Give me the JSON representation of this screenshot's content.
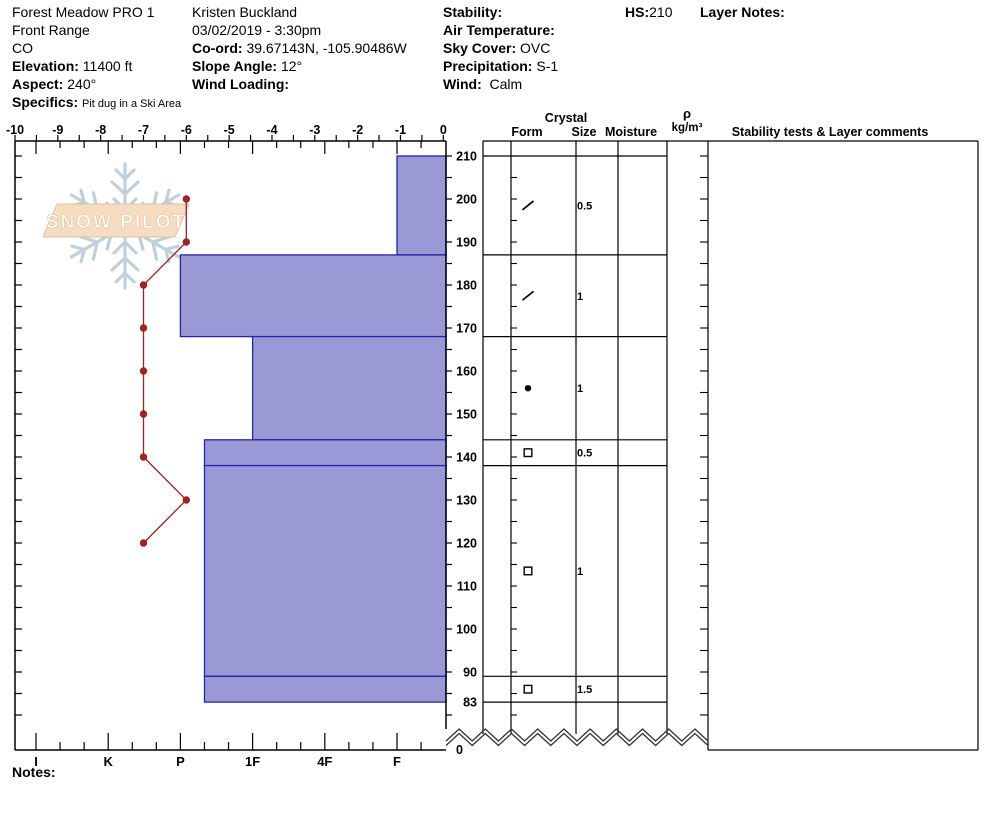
{
  "header": {
    "pit_name": "Forest Meadow PRO 1",
    "range": "Front Range",
    "state": "CO",
    "elevation_label": "Elevation:",
    "elevation_value": "11400 ft",
    "aspect_label": "Aspect:",
    "aspect_value": "240°",
    "specifics_label": "Specifics:",
    "specifics_value": "Pit dug in a Ski Area",
    "observer": "Kristen Buckland",
    "datetime": "03/02/2019 - 3:30pm",
    "coord_label": "Co-ord:",
    "coord_value": "39.67143N, -105.90486W",
    "slope_angle_label": "Slope Angle:",
    "slope_angle_value": "12°",
    "wind_loading_label": "Wind Loading:",
    "wind_loading_value": "",
    "stability_label": "Stability:",
    "stability_value": "",
    "air_temp_label": "Air Temperature:",
    "air_temp_value": "",
    "sky_cover_label": "Sky Cover:",
    "sky_cover_value": "OVC",
    "precipitation_label": "Precipitation:",
    "precipitation_value": "S-1",
    "wind_label": "Wind:",
    "wind_value": "Calm",
    "hs_label": "HS:",
    "hs_value": "210",
    "layer_notes_label": "Layer Notes:"
  },
  "watermark": {
    "text": "SNOW PILOT"
  },
  "table_headers": {
    "crystal": "Crystal",
    "form": "Form",
    "size": "Size",
    "moisture": "Moisture",
    "rho": "ρ",
    "rho_units": "kg/m³",
    "comments": "Stability tests & Layer comments"
  },
  "notes_label": "Notes:",
  "chart_data": {
    "type": "snow-profile",
    "title": "Snow pit profile: hardness layers vs depth with temperature trace",
    "depth_axis": {
      "unit": "cm",
      "surface": 210,
      "pit_bottom": 83,
      "tick_labels": [
        210,
        200,
        190,
        180,
        170,
        160,
        150,
        140,
        130,
        120,
        110,
        100,
        90,
        83
      ],
      "ground_label": "0",
      "minor_tick_step_cm": 5
    },
    "temp_axis": {
      "unit": "°C",
      "tick_labels": [
        -10,
        -9,
        -8,
        -7,
        -6,
        -5,
        -4,
        -3,
        -2,
        -1,
        0
      ],
      "minor_step": 0.5,
      "range": [
        -10,
        0
      ]
    },
    "hardness_axis": {
      "categories": [
        "I",
        "K",
        "P",
        "1F",
        "4F",
        "F"
      ]
    },
    "layers": [
      {
        "top": 210,
        "bottom": 187,
        "hardness": "F",
        "form": "decomposing",
        "size": "0.5",
        "moisture": "",
        "comments": ""
      },
      {
        "top": 187,
        "bottom": 168,
        "hardness": "P",
        "form": "decomposing",
        "size": "1",
        "moisture": "",
        "comments": ""
      },
      {
        "top": 168,
        "bottom": 144,
        "hardness": "1F",
        "form": "rounds",
        "size": "1",
        "moisture": "",
        "comments": ""
      },
      {
        "top": 144,
        "bottom": 138,
        "hardness": "P+",
        "form": "facets",
        "size": "0.5",
        "moisture": "",
        "comments": ""
      },
      {
        "top": 138,
        "bottom": 89,
        "hardness": "P+",
        "form": "facets",
        "size": "1",
        "moisture": "",
        "comments": ""
      },
      {
        "top": 89,
        "bottom": 83,
        "hardness": "P+",
        "form": "facets",
        "size": "1.5",
        "moisture": "",
        "comments": ""
      }
    ],
    "temperature_profile": [
      {
        "depth": 200,
        "temp_c": -6
      },
      {
        "depth": 190,
        "temp_c": -6
      },
      {
        "depth": 180,
        "temp_c": -7
      },
      {
        "depth": 170,
        "temp_c": -7
      },
      {
        "depth": 160,
        "temp_c": -7
      },
      {
        "depth": 150,
        "temp_c": -7
      },
      {
        "depth": 140,
        "temp_c": -7
      },
      {
        "depth": 130,
        "temp_c": -6
      },
      {
        "depth": 120,
        "temp_c": -7
      }
    ],
    "colors": {
      "layer_fill": "#9a99d6",
      "layer_border": "#2424b2",
      "temp_line": "#a02222",
      "frame": "#000000",
      "watermark_flake": "#bdd0dc",
      "watermark_banner": "#f6ddc2",
      "watermark_banner_border": "#e3c09a"
    }
  }
}
